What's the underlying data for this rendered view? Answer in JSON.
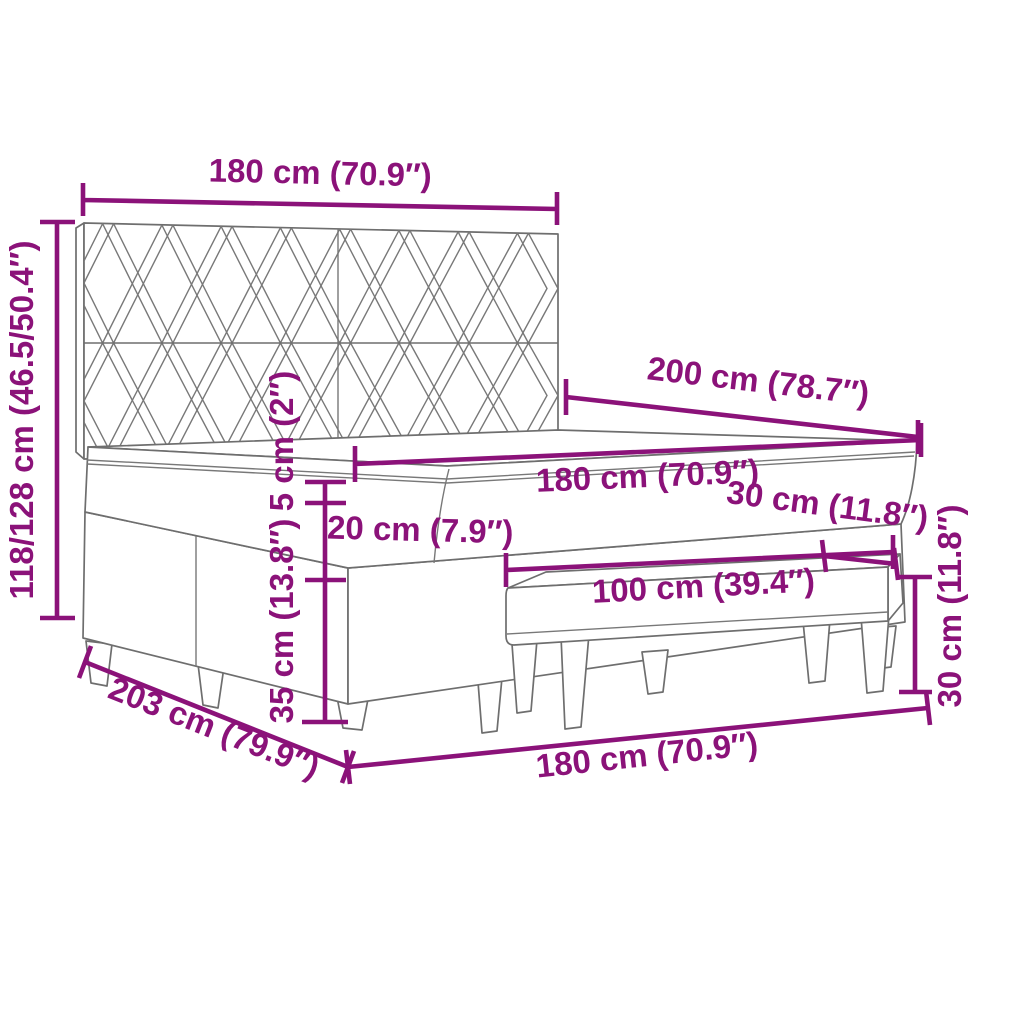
{
  "diagram": {
    "title": "Box spring bed with headboard, mattress and bench — dimension diagram",
    "colors": {
      "dimension_accent": "#8b1279",
      "furniture_line": "#6e6e6e",
      "background": "#ffffff"
    },
    "dimensions": {
      "headboard_width": "180 cm (70.9″)",
      "bed_height": "118/128 cm (46.5/50.4″)",
      "topper_height": "5 cm (2″)",
      "bed_length": "200 cm (78.7″)",
      "mattress_width": "180 cm (70.9″)",
      "mattress_height": "20 cm (7.9″)",
      "base_height": "35 cm (13.8″)",
      "bench_depth": "30 cm (11.8″)",
      "bench_length": "100 cm (39.4″)",
      "bench_height": "30 cm (11.8″)",
      "base_length": "203 cm (79.9″)",
      "bed_width": "180 cm (70.9″)"
    }
  }
}
